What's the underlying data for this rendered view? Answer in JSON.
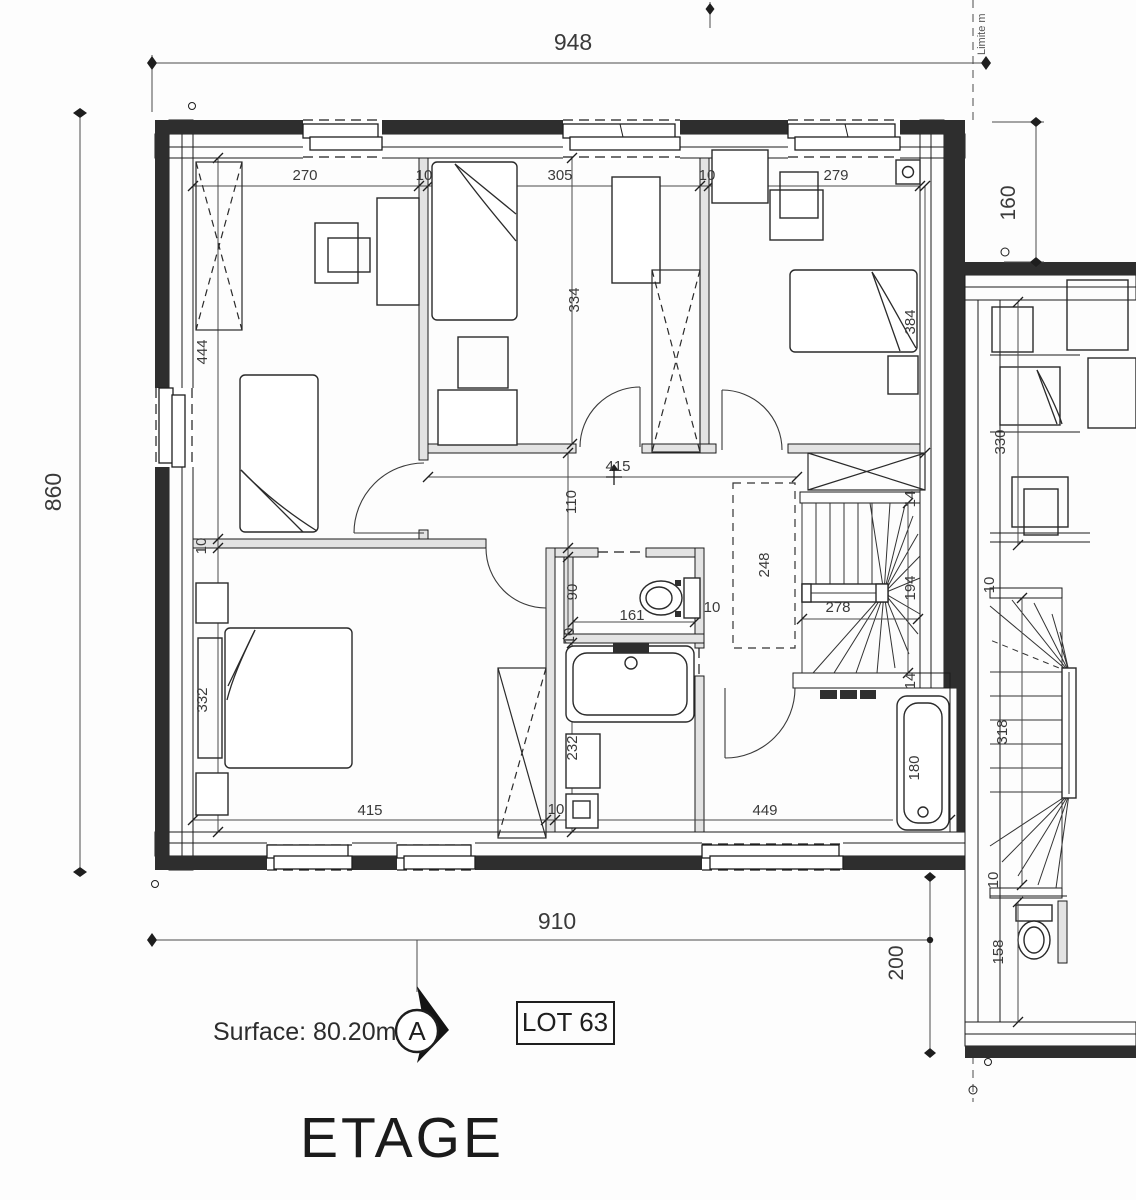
{
  "drawing": {
    "title": "ETAGE",
    "surface": "Surface: 80.20m²",
    "lot": "LOT 63",
    "section_marker": "A",
    "boundary_label": "Limite m"
  },
  "dims": {
    "overall_width_top": "948",
    "overall_height_left": "860",
    "right_setback": "160",
    "overall_width_bottom": "910",
    "bottom_right_setback": "200",
    "bedroom1_width": "270",
    "partition1": "10",
    "bedroom2_width": "305",
    "partition2": "10",
    "bedroom3_width": "279",
    "bedroom1_depth": "444",
    "partition3": "10",
    "bedroom4_depth": "332",
    "bedroom2_depth": "334",
    "bedroom3_depth": "384",
    "hall_width": "415",
    "hall_depth": "110",
    "wc_depth": "90",
    "wc_width": "161",
    "wc_wall": "10",
    "wc_wall2": "10",
    "void_depth": "248",
    "stair_run": "278",
    "stair_width": "194",
    "stair_wall_top": "14",
    "stair_wall_bottom": "14",
    "bedroom4_width": "415",
    "bath_partition": "10",
    "bath_depth": "232",
    "room5_width": "449",
    "bathtub_length": "180",
    "n_bed_depth": "330",
    "n_wall1": "10",
    "n_stair_run": "318",
    "n_wall2": "10",
    "n_wc_depth": "158"
  }
}
